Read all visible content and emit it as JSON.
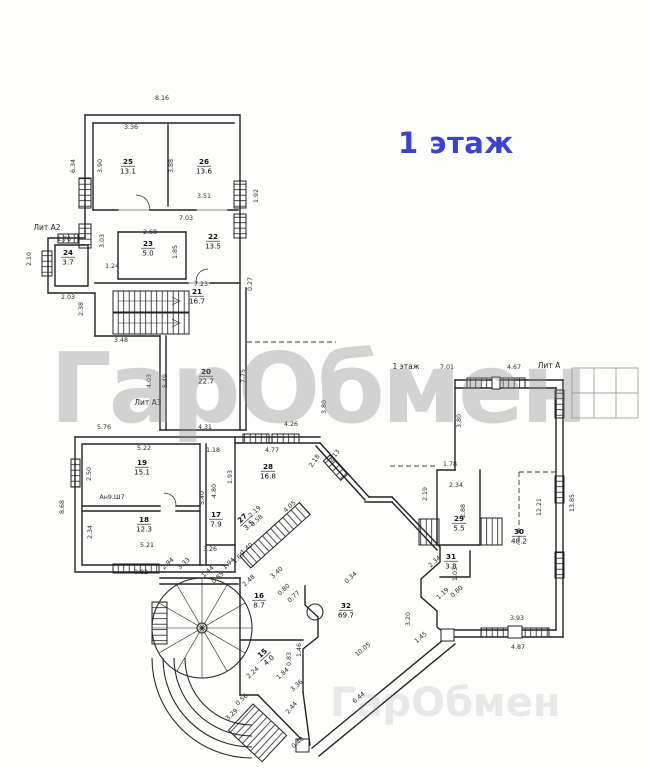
{
  "title": {
    "text": "1 этаж",
    "color": "#3b42cc"
  },
  "watermarks": {
    "primary": "ГарОбмен",
    "secondary": "ГарОбмен"
  },
  "plan": {
    "building_labels": [
      {
        "text": "Лит А2",
        "x": 47,
        "y": 230
      },
      {
        "text": "Лит А3",
        "x": 148,
        "y": 405
      },
      {
        "text": "Лит А",
        "x": 549,
        "y": 368
      },
      {
        "text": "1 этаж",
        "x": 406,
        "y": 369
      }
    ],
    "rooms": [
      {
        "number": "25",
        "area": "13.1",
        "x": 128,
        "y": 164
      },
      {
        "number": "26",
        "area": "13.6",
        "x": 204,
        "y": 164
      },
      {
        "number": "24",
        "area": "3.7",
        "x": 68,
        "y": 255
      },
      {
        "number": "23",
        "area": "5.0",
        "x": 148,
        "y": 246
      },
      {
        "number": "22",
        "area": "13.5",
        "x": 213,
        "y": 239
      },
      {
        "number": "21",
        "area": "16.7",
        "x": 197,
        "y": 294
      },
      {
        "number": "20",
        "area": "22.7",
        "x": 206,
        "y": 374
      },
      {
        "number": "19",
        "area": "15.1",
        "x": 142,
        "y": 465
      },
      {
        "number": "18",
        "area": "12.3",
        "x": 144,
        "y": 522
      },
      {
        "number": "17",
        "area": "7.9",
        "x": 216,
        "y": 517
      },
      {
        "number": "28",
        "area": "16.8",
        "x": 268,
        "y": 469
      },
      {
        "number": "27",
        "area": "3.5",
        "x": 244,
        "y": 520,
        "rot": -42
      },
      {
        "number": "16",
        "area": "8.7",
        "x": 259,
        "y": 598
      },
      {
        "number": "15",
        "area": "4.0",
        "x": 264,
        "y": 655,
        "rot": -42
      },
      {
        "number": "32",
        "area": "69.7",
        "x": 346,
        "y": 608
      },
      {
        "number": "29",
        "area": "5.5",
        "x": 459,
        "y": 521
      },
      {
        "number": "31",
        "area": "3.8",
        "x": 451,
        "y": 559
      },
      {
        "number": "30",
        "area": "48.2",
        "x": 519,
        "y": 534
      }
    ],
    "dimensions": [
      {
        "t": "8.16",
        "x": 162,
        "y": 100
      },
      {
        "t": "3.36",
        "x": 131,
        "y": 129
      },
      {
        "t": "6.34",
        "x": 75,
        "y": 166,
        "r": -90
      },
      {
        "t": "3.90",
        "x": 102,
        "y": 166,
        "r": -90
      },
      {
        "t": "3.88",
        "x": 173,
        "y": 166,
        "r": -90
      },
      {
        "t": "3.51",
        "x": 204,
        "y": 198
      },
      {
        "t": "7.03",
        "x": 186,
        "y": 220
      },
      {
        "t": "1.92",
        "x": 258,
        "y": 196,
        "r": -90
      },
      {
        "t": "0.27",
        "x": 252,
        "y": 284,
        "r": -90
      },
      {
        "t": "1.76",
        "x": 64,
        "y": 241
      },
      {
        "t": "2.10",
        "x": 31,
        "y": 259,
        "r": -90
      },
      {
        "t": "2.03",
        "x": 68,
        "y": 299
      },
      {
        "t": "3.03",
        "x": 104,
        "y": 241,
        "r": -90
      },
      {
        "t": "2.68",
        "x": 150,
        "y": 234
      },
      {
        "t": "1.85",
        "x": 177,
        "y": 252,
        "r": -90
      },
      {
        "t": "1.24",
        "x": 112,
        "y": 268
      },
      {
        "t": "7.23",
        "x": 201,
        "y": 286
      },
      {
        "t": "2.38",
        "x": 83,
        "y": 309,
        "r": -90
      },
      {
        "t": "3.48",
        "x": 121,
        "y": 342
      },
      {
        "t": "4.03",
        "x": 151,
        "y": 381,
        "r": -90
      },
      {
        "t": "5.49",
        "x": 167,
        "y": 381,
        "r": -90
      },
      {
        "t": "7.75",
        "x": 245,
        "y": 376,
        "r": -90
      },
      {
        "t": "3.80",
        "x": 326,
        "y": 407,
        "r": -90
      },
      {
        "t": "5.76",
        "x": 104,
        "y": 429
      },
      {
        "t": "4.31",
        "x": 205,
        "y": 429
      },
      {
        "t": "4.26",
        "x": 291,
        "y": 426
      },
      {
        "t": "1.18",
        "x": 213,
        "y": 452
      },
      {
        "t": "4.77",
        "x": 272,
        "y": 452
      },
      {
        "t": "8.68",
        "x": 64,
        "y": 507,
        "r": -90
      },
      {
        "t": "5.22",
        "x": 144,
        "y": 450
      },
      {
        "t": "2.50",
        "x": 91,
        "y": 474,
        "r": -90
      },
      {
        "t": "Ан9.Ш7",
        "x": 112,
        "y": 499
      },
      {
        "t": "5.40",
        "x": 204,
        "y": 498,
        "r": -90
      },
      {
        "t": "4.80",
        "x": 216,
        "y": 491,
        "r": -90
      },
      {
        "t": "2.34",
        "x": 92,
        "y": 532,
        "r": -90
      },
      {
        "t": "5.21",
        "x": 147,
        "y": 547
      },
      {
        "t": "3.26",
        "x": 210,
        "y": 551
      },
      {
        "t": "0.82",
        "x": 141,
        "y": 574
      },
      {
        "t": "1.93",
        "x": 232,
        "y": 477,
        "r": -90
      },
      {
        "t": "2.13",
        "x": 336,
        "y": 457,
        "r": -55
      },
      {
        "t": "2.18",
        "x": 316,
        "y": 462,
        "r": -55
      },
      {
        "t": "4.05",
        "x": 291,
        "y": 508,
        "r": -42
      },
      {
        "t": "2.19",
        "x": 256,
        "y": 513,
        "r": -42
      },
      {
        "t": "0.58",
        "x": 258,
        "y": 522,
        "r": -42
      },
      {
        "t": "1.40",
        "x": 248,
        "y": 550,
        "r": -42
      },
      {
        "t": "1.65",
        "x": 240,
        "y": 559,
        "r": -42
      },
      {
        "t": "1.94",
        "x": 230,
        "y": 565,
        "r": -42
      },
      {
        "t": "2.94",
        "x": 169,
        "y": 565,
        "r": -42
      },
      {
        "t": "3.33",
        "x": 185,
        "y": 565,
        "r": -42
      },
      {
        "t": "1.44",
        "x": 209,
        "y": 573,
        "r": -42
      },
      {
        "t": "0.85",
        "x": 219,
        "y": 579,
        "r": -42
      },
      {
        "t": "2.48",
        "x": 250,
        "y": 582,
        "r": -42
      },
      {
        "t": "3.40",
        "x": 278,
        "y": 574,
        "r": -42
      },
      {
        "t": "0.80",
        "x": 285,
        "y": 591,
        "r": -42
      },
      {
        "t": "0.77",
        "x": 295,
        "y": 598,
        "r": -42
      },
      {
        "t": "0.83",
        "x": 291,
        "y": 659,
        "r": -90
      },
      {
        "t": "1.46",
        "x": 301,
        "y": 650,
        "r": -90
      },
      {
        "t": "2.24",
        "x": 254,
        "y": 674,
        "r": -42
      },
      {
        "t": "1.84",
        "x": 284,
        "y": 675,
        "r": -42
      },
      {
        "t": "3.36",
        "x": 298,
        "y": 687,
        "r": -42
      },
      {
        "t": "0.56",
        "x": 243,
        "y": 701,
        "r": -42
      },
      {
        "t": "3.29",
        "x": 233,
        "y": 716,
        "r": -42
      },
      {
        "t": "0.34",
        "x": 352,
        "y": 579,
        "r": -42
      },
      {
        "t": "10.05",
        "x": 364,
        "y": 651,
        "r": -40
      },
      {
        "t": "6.44",
        "x": 360,
        "y": 699,
        "r": -40
      },
      {
        "t": "2.44",
        "x": 293,
        "y": 709,
        "r": -50
      },
      {
        "t": "0.40",
        "x": 299,
        "y": 744,
        "r": -40
      },
      {
        "t": "1.45",
        "x": 422,
        "y": 639,
        "r": -40
      },
      {
        "t": "7.01",
        "x": 447,
        "y": 369
      },
      {
        "t": "4.67",
        "x": 514,
        "y": 369
      },
      {
        "t": "3.80",
        "x": 461,
        "y": 421,
        "r": -90
      },
      {
        "t": "1.78",
        "x": 450,
        "y": 466
      },
      {
        "t": "2.34",
        "x": 456,
        "y": 487
      },
      {
        "t": "2.19",
        "x": 427,
        "y": 494,
        "r": -90
      },
      {
        "t": "2.88",
        "x": 465,
        "y": 511,
        "r": -90
      },
      {
        "t": "12.21",
        "x": 541,
        "y": 507,
        "r": -90
      },
      {
        "t": "13.85",
        "x": 574,
        "y": 503,
        "r": -90
      },
      {
        "t": "2.34",
        "x": 436,
        "y": 563,
        "r": -42
      },
      {
        "t": "1.03",
        "x": 457,
        "y": 574,
        "r": -90
      },
      {
        "t": "1.19",
        "x": 444,
        "y": 595,
        "r": -42
      },
      {
        "t": "0.60",
        "x": 458,
        "y": 593,
        "r": -42
      },
      {
        "t": "3.20",
        "x": 410,
        "y": 619,
        "r": -90
      },
      {
        "t": "3.93",
        "x": 517,
        "y": 620
      },
      {
        "t": "4.87",
        "x": 518,
        "y": 649
      }
    ]
  }
}
